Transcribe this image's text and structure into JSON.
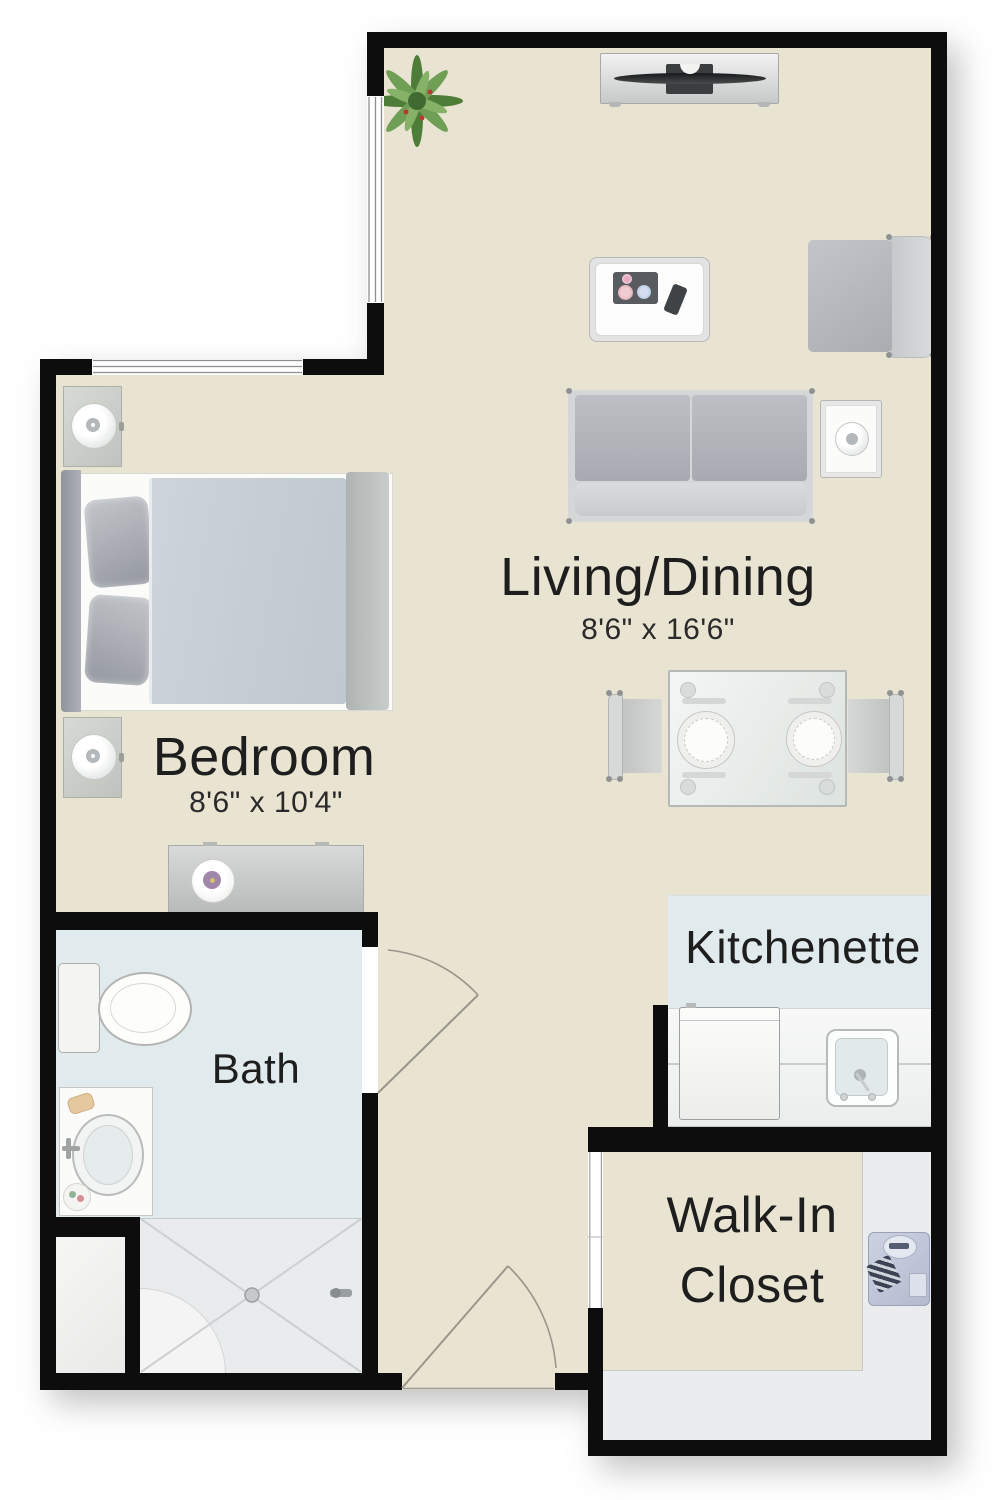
{
  "rooms": {
    "living_dining": {
      "label": "Living/Dining",
      "dimensions": "8'6\" x 16'6\""
    },
    "bedroom": {
      "label": "Bedroom",
      "dimensions": "8'6\" x 10'4\""
    },
    "bath": {
      "label": "Bath"
    },
    "kitchenette": {
      "label": "Kitchenette"
    },
    "walk_in_closet": {
      "label_line1": "Walk-In",
      "label_line2": "Closet"
    }
  },
  "colors": {
    "background": "#ffffff",
    "wall": "#0d0d0d",
    "floor_main": "#e9e4d1",
    "floor_wet": "#e1eaec",
    "floor_closet": "#eaecee",
    "text": "#1e1e1e",
    "door_line": "#9a958a",
    "plant_green": "#5c8a46"
  },
  "furniture_icons": {
    "living_dining": [
      "potted-plant-icon",
      "tv-console-icon",
      "flat-tv-icon",
      "coffee-table-icon",
      "serving-tray-icon",
      "cup-icon",
      "remote-icon",
      "armchair-icon",
      "side-table-icon",
      "table-lamp-icon",
      "loveseat-sofa-icon",
      "dining-table-icon",
      "dinner-plate-icon",
      "dining-chair-icon"
    ],
    "bedroom": [
      "bed-icon",
      "pillow-icon",
      "comforter-icon",
      "nightstand-icon",
      "table-lamp-icon",
      "dresser-icon"
    ],
    "bath": [
      "toilet-icon",
      "vanity-sink-icon",
      "shower-icon",
      "shower-seat-icon",
      "shower-drain-icon"
    ],
    "kitchenette": [
      "refrigerator-icon",
      "counter-icon",
      "kitchen-sink-icon"
    ],
    "walk_in_closet": [
      "folded-shirt-icon",
      "necktie-icon"
    ]
  }
}
